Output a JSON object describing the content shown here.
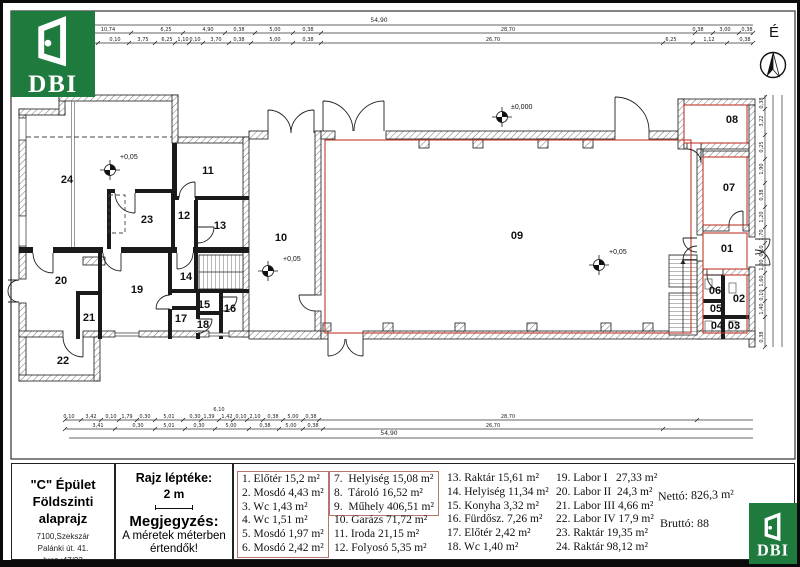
{
  "sheet": {
    "building": "\"C\" Épület",
    "subtitle": "Földszinti alaprajz",
    "address1": "7100,Szekszár",
    "address2": "Palánki út. 41.",
    "address3": "hrsz.:47/23",
    "scale_label": "Rajz léptéke:",
    "scale_value": "2 m",
    "note_title": "Megjegyzés:",
    "note_line1": "A méretek méterben",
    "note_line2": "értendők!"
  },
  "legend": {
    "col1": [
      "1. Előtér 15,2 m²",
      "2. Mosdó 4,43 m²",
      "3. Wc 1,43 m²",
      "4. Wc 1,51 m²",
      "5. Mosdó 1,97 m²",
      "6. Mosdó 2,42 m²"
    ],
    "col2a": [
      "7.  Helyiség 15,08 m²",
      "8.  Tároló 16,52 m²",
      "9.  Műhely 406,51 m²"
    ],
    "col2b": [
      "10. Garázs 71,72 m²",
      "11. Iroda 21,15 m²",
      "12. Folyosó 5,35 m²"
    ],
    "col3": [
      "13. Raktár 15,61 m²",
      "14. Helyiség 11,34 m²",
      "15. Konyha 3,32 m²",
      "16. Fürdősz. 7,26 m²",
      "17. Előtér 2,42 m²",
      "18. Wc 1,40 m²"
    ],
    "col4": [
      "19. Labor I   27,33 m²",
      "20. Labor II  24,3 m²",
      "21. Labor III 4,66 m²",
      "22. Labor IV 17,9 m²",
      "23. Raktár 19,35 m²",
      "24. Raktár 98,12 m²"
    ],
    "netto": "Nettó: 826,3 m²",
    "brutto": "Bruttó: 88"
  },
  "plan": {
    "rooms": [
      "01",
      "02",
      "03",
      "04",
      "05",
      "06",
      "07",
      "08",
      "09",
      "10",
      "11",
      "12",
      "13",
      "14",
      "15",
      "16",
      "17",
      "18",
      "19",
      "20",
      "21",
      "22",
      "23",
      "24"
    ],
    "levels": [
      "±0,000",
      "+0,05",
      "+0,05",
      "+0,05"
    ]
  },
  "north": {
    "label": "É"
  },
  "logo": {
    "text": "DBI"
  },
  "dims": {
    "top_total": "54,90",
    "bottom_total": "54,90",
    "extra": "6,10",
    "top1": [
      "10,74",
      "6,25",
      "4,90",
      "0,38",
      "5,00",
      "0,38",
      "28,70",
      "0,38",
      "3,00",
      "0,38"
    ],
    "top2": [
      "6,49",
      "0,10",
      "3,75",
      "6,25",
      "1,10",
      "0,10",
      "3,70",
      "0,38",
      "5,00",
      "0,38",
      "26,70",
      "6,25",
      "1,12",
      "0,38"
    ],
    "bottom1": [
      "0,10",
      "3,42",
      "0,10",
      "1,79",
      "0,30",
      "5,01",
      "0,30",
      "1,39",
      "1,42",
      "0,10",
      "2,10",
      "0,38",
      "5,00",
      "0,38",
      "28,70"
    ],
    "bottom2": [
      "3,41",
      "0,30",
      "5,01",
      "0,30",
      "5,00",
      "0,38",
      "5,00",
      "0,38",
      "26,70"
    ],
    "right1": [
      "0,38",
      "3,22",
      "0,25",
      "1,90",
      "0,38",
      "1,20",
      "1,70",
      "0,10",
      "1,00",
      "1,60",
      "0,10",
      "1,40",
      "0,38"
    ]
  },
  "colors": {
    "accent_red": "#c0392b",
    "legend_box": "#b5776b",
    "logo_green": "#1f7a3d"
  }
}
